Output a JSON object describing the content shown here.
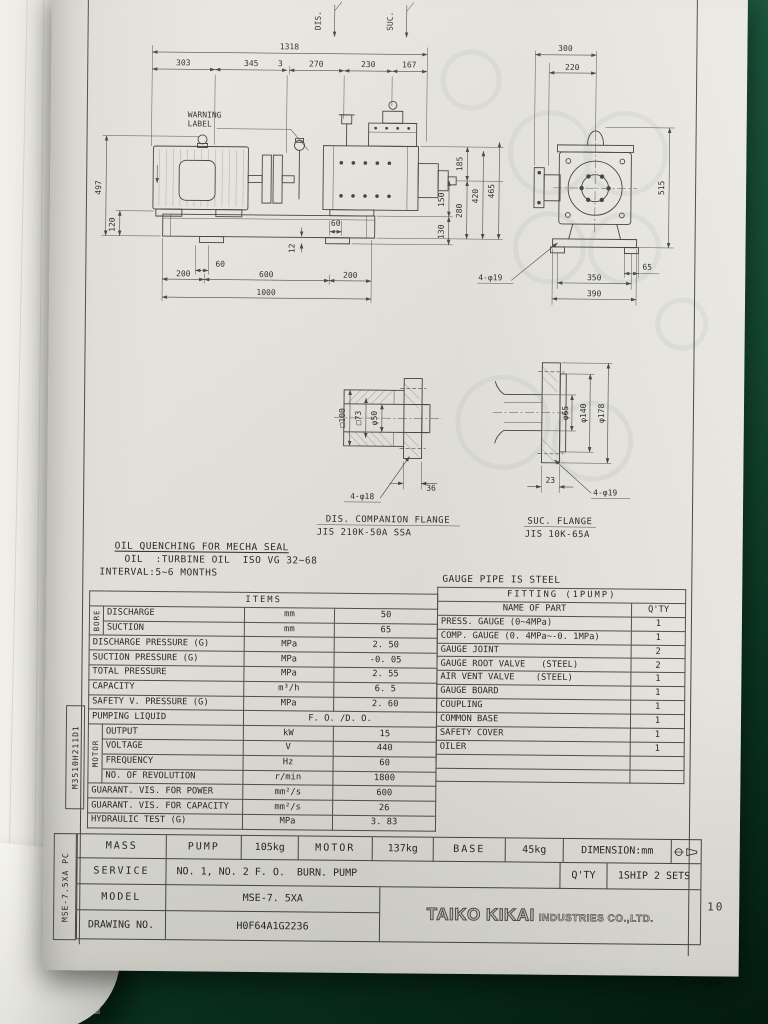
{
  "page_number": "10",
  "margin_codes": {
    "upper": "M3510H211D1",
    "lower": "MSE-7.5XA PC"
  },
  "drawing": {
    "labels": {
      "dis": "DIS.",
      "suc": "SUC.",
      "warning_line1": "WARNING",
      "warning_line2": "LABEL"
    },
    "front_dims": {
      "overall": "1318",
      "seg_303": "303",
      "seg_345": "345",
      "seg_3": "3",
      "seg_270": "270",
      "seg_230": "230",
      "seg_167": "167",
      "height_497": "497",
      "height_120": "120",
      "h185": "185",
      "h150": "150",
      "h130": "130",
      "h280": "280",
      "h420": "420",
      "h465": "465",
      "foot_60": "60",
      "lip_12": "12",
      "hole_60": "60",
      "base_200l": "200",
      "base_600": "600",
      "base_200r": "200",
      "base_1000": "1000",
      "base_holes": "4-φ19"
    },
    "side_dims": {
      "w300": "300",
      "w220": "220",
      "h515": "515",
      "f65": "65",
      "b350": "350",
      "b390": "390"
    },
    "dis_flange": {
      "title": "DIS. COMPANION FLANGE",
      "spec": "JIS 210K-50A SSA",
      "dims": {
        "sq100": "□100",
        "sq73": "□73",
        "d50": "φ50",
        "thk": "36",
        "holes": "4-φ18"
      }
    },
    "suc_flange": {
      "title": "SUC. FLANGE",
      "spec": "JIS 10K-65A",
      "dims": {
        "d65": "φ65",
        "d140": "φ140",
        "d178": "φ178",
        "thk": "23",
        "holes": "4-φ19"
      }
    }
  },
  "notes": {
    "seal": "OIL QUENCHING FOR MECHA SEAL",
    "oil": "OIL  :TURBINE OIL  ISO VG 32~68",
    "interval": "INTERVAL:5~6 MONTHS",
    "gauge": "GAUGE PIPE IS STEEL"
  },
  "items_table": {
    "title": "ITEMS",
    "bore_label": "BORE",
    "motor_label": "MOTOR",
    "rows": [
      {
        "name": "DISCHARGE",
        "unit": "mm",
        "value": "50"
      },
      {
        "name": "SUCTION",
        "unit": "mm",
        "value": "65"
      },
      {
        "name": "DISCHARGE PRESSURE (G)",
        "unit": "MPa",
        "value": "2. 50"
      },
      {
        "name": "SUCTION PRESSURE (G)",
        "unit": "MPa",
        "value": "-0. 05"
      },
      {
        "name": "TOTAL PRESSURE",
        "unit": "MPa",
        "value": "2. 55"
      },
      {
        "name": "CAPACITY",
        "unit": "m³/h",
        "value": "6. 5"
      },
      {
        "name": "SAFETY V. PRESSURE (G)",
        "unit": "MPa",
        "value": "2. 60"
      },
      {
        "name": "PUMPING LIQUID",
        "value": "F. O. /D. O."
      },
      {
        "name": "OUTPUT",
        "unit": "kW",
        "value": "15"
      },
      {
        "name": "VOLTAGE",
        "unit": "V",
        "value": "440"
      },
      {
        "name": "FREQUENCY",
        "unit": "Hz",
        "value": "60"
      },
      {
        "name": "NO. OF REVOLUTION",
        "unit": "r/min",
        "value": "1800"
      },
      {
        "name": "GUARANT. VIS. FOR POWER",
        "unit": "mm²/s",
        "value": "600"
      },
      {
        "name": "GUARANT. VIS. FOR CAPACITY",
        "unit": "mm²/s",
        "value": "26"
      },
      {
        "name": "HYDRAULIC TEST (G)",
        "unit": "MPa",
        "value": "3. 83"
      }
    ]
  },
  "fitting_table": {
    "title": "FITTING (1PUMP)",
    "name_header": "NAME OF PART",
    "qty_header": "Q'TY",
    "rows": [
      {
        "name": "PRESS. GAUGE (0~4MPa)",
        "qty": "1"
      },
      {
        "name": "COMP. GAUGE (0. 4MPa~-0. 1MPa)",
        "qty": "1"
      },
      {
        "name": "GAUGE JOINT",
        "qty": "2"
      },
      {
        "name": "GAUGE ROOT VALVE   (STEEL)",
        "qty": "2"
      },
      {
        "name": "AIR VENT VALVE    (STEEL)",
        "qty": "1"
      },
      {
        "name": "GAUGE BOARD",
        "qty": "1"
      },
      {
        "name": "COUPLING",
        "qty": "1"
      },
      {
        "name": "COMMON BASE",
        "qty": "1"
      },
      {
        "name": "SAFETY COVER",
        "qty": "1"
      },
      {
        "name": "OILER",
        "qty": "1"
      }
    ]
  },
  "title_block": {
    "mass_label": "MASS",
    "pump_label": "PUMP",
    "pump_value": "105kg",
    "motor_label": "MOTOR",
    "motor_value": "137kg",
    "base_label": "BASE",
    "base_value": "45kg",
    "dimension_label": "DIMENSION:mm",
    "service_label": "SERVICE",
    "service_value": "NO. 1, NO. 2 F. O.  BURN. PUMP",
    "qty_label": "Q'TY",
    "qty_value": "1SHIP 2 SETS",
    "model_label": "MODEL",
    "model_value": "MSE-7. 5XA",
    "drawing_no_label": "DRAWING NO.",
    "drawing_no_value": "H0F64A1G2236",
    "company_main": "TAIKO KIKAI",
    "company_sub": "INDUSTRIES CO.,LTD."
  },
  "icons": {
    "projection_symbol": "first-angle-projection"
  }
}
